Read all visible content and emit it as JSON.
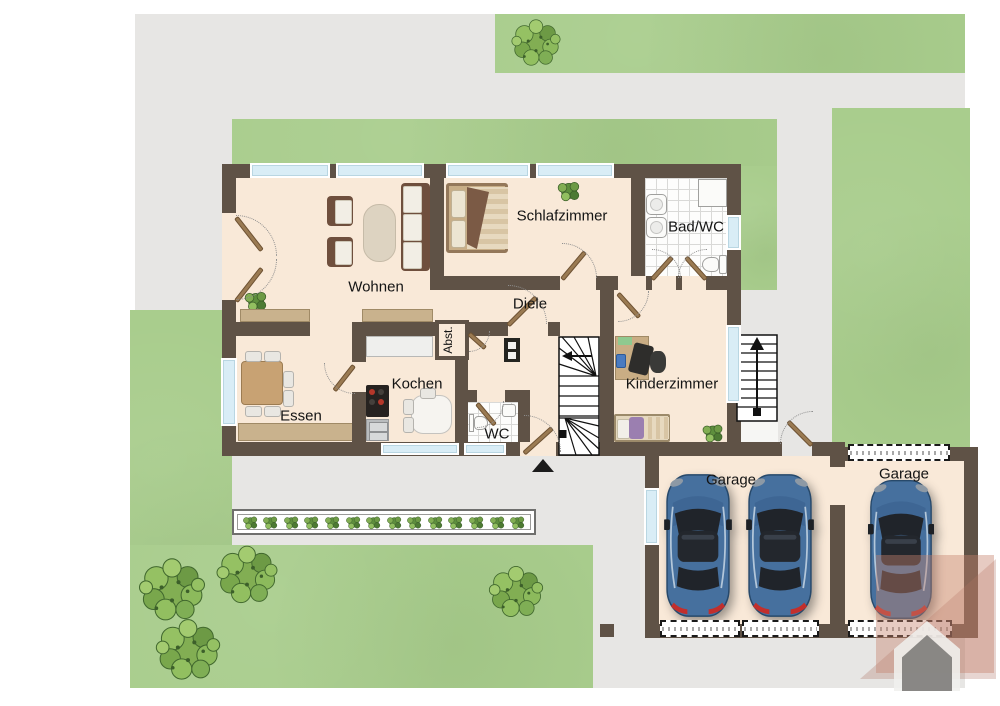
{
  "rooms": {
    "wohnen": "Wohnen",
    "schlafzimmer": "Schlafzimmer",
    "bad": "Bad/WC",
    "diele": "Diele",
    "abst": "Abst.",
    "kochen": "Kochen",
    "essen": "Essen",
    "wc": "WC",
    "kinderzimmer": "Kinderzimmer",
    "garage_left": "Garage",
    "garage_right": "Garage"
  },
  "colors": {
    "wall": "#5f5246",
    "floor": "#f9e9d8",
    "grass": "#a9cd8d",
    "pavement": "#e7e6e4",
    "window": "#d9edf6",
    "car_body": "#46709e",
    "kid_bed_accent": "#9b7fb0"
  },
  "garden": {
    "planter_plant_count": 14
  }
}
